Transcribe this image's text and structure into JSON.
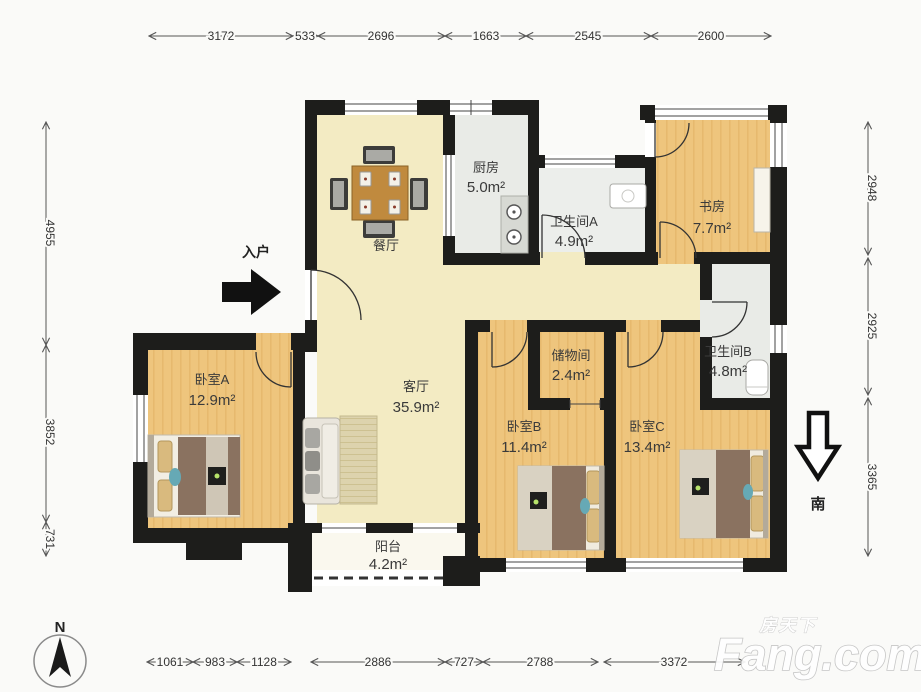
{
  "title": "apartment-floor-plan",
  "compass": {
    "north_label": "N",
    "south_label": "南"
  },
  "entry": {
    "label": "入户"
  },
  "watermark": {
    "cn": "房天下",
    "en": "Fang.com"
  },
  "rooms": [
    {
      "id": "dining",
      "name": "餐厅",
      "area": ""
    },
    {
      "id": "kitchen",
      "name": "厨房",
      "area": "5.0m²"
    },
    {
      "id": "bathA",
      "name": "卫生间A",
      "area": "4.9m²"
    },
    {
      "id": "study",
      "name": "书房",
      "area": "7.7m²"
    },
    {
      "id": "living",
      "name": "客厅",
      "area": "35.9m²"
    },
    {
      "id": "bedA",
      "name": "卧室A",
      "area": "12.9m²"
    },
    {
      "id": "storage",
      "name": "储物间",
      "area": "2.4m²"
    },
    {
      "id": "bathB",
      "name": "卫生间B",
      "area": "4.8m²"
    },
    {
      "id": "bedB",
      "name": "卧室B",
      "area": "11.4m²"
    },
    {
      "id": "bedC",
      "name": "卧室C",
      "area": "13.4m²"
    },
    {
      "id": "balcony",
      "name": "阳台",
      "area": "4.2m²"
    }
  ],
  "dimensions": {
    "top": [
      "3172",
      "533",
      "2696",
      "1663",
      "2545",
      "2600"
    ],
    "bottom": [
      "1061",
      "983",
      "1128",
      "2886",
      "727",
      "2788",
      "3372"
    ],
    "left": [
      "4955",
      "3852",
      "731"
    ],
    "right": [
      "2948",
      "2925",
      "3365"
    ]
  },
  "colors": {
    "wall": "#1d1d1b",
    "floor_yellow": "#f3ebc3",
    "floor_wood": "#eec57d",
    "floor_tile": "#e9ebe7",
    "floor_balcony": "#faf8ee"
  }
}
